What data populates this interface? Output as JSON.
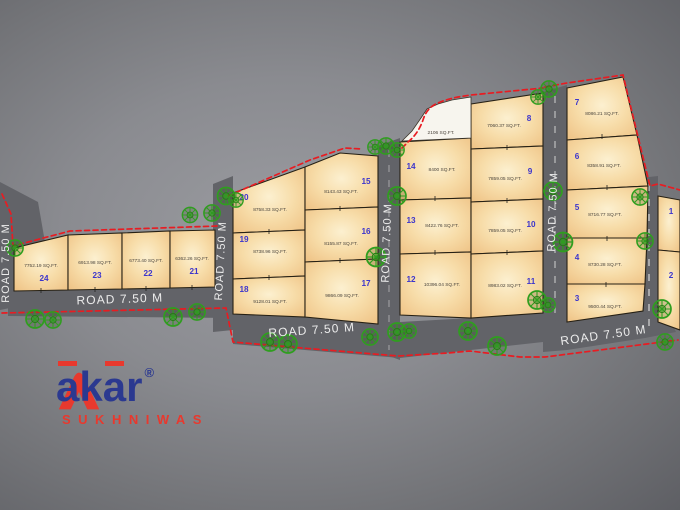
{
  "road_label": "ROAD 7.50 M",
  "open_plot": {
    "area": "2106 SQ.FT."
  },
  "plots": {
    "p1": {
      "num": "1",
      "area": ""
    },
    "p2": {
      "num": "2",
      "area": ""
    },
    "p3": {
      "num": "3",
      "area": "9500.44 SQ.FT."
    },
    "p4": {
      "num": "4",
      "area": "8730.28 SQ.FT."
    },
    "p5": {
      "num": "5",
      "area": "8716.77 SQ.FT."
    },
    "p6": {
      "num": "6",
      "area": "8358.91 SQ.FT."
    },
    "p7": {
      "num": "7",
      "area": "8086.21 SQ.FT."
    },
    "p8": {
      "num": "8",
      "area": "7060.37 SQ.FT."
    },
    "p9": {
      "num": "9",
      "area": "7859.05 SQ.FT."
    },
    "p10": {
      "num": "10",
      "area": "7859.05 SQ.FT."
    },
    "p11": {
      "num": "11",
      "area": "8983.02 SQ.FT."
    },
    "p12": {
      "num": "12",
      "area": "10396.04 SQ.FT."
    },
    "p13": {
      "num": "13",
      "area": "8422.76 SQ.FT."
    },
    "p14": {
      "num": "14",
      "area": "8400 SQ.FT."
    },
    "p15": {
      "num": "15",
      "area": "8143.43 SQ.FT."
    },
    "p16": {
      "num": "16",
      "area": "8155.87 SQ.FT."
    },
    "p17": {
      "num": "17",
      "area": "9866.09 SQ.FT."
    },
    "p18": {
      "num": "18",
      "area": "9128.01 SQ.FT."
    },
    "p19": {
      "num": "19",
      "area": "8738.96 SQ.FT."
    },
    "p20": {
      "num": "20",
      "area": "8758.33 SQ.FT."
    },
    "p21": {
      "num": "21",
      "area": "6362.26 SQ.FT."
    },
    "p22": {
      "num": "22",
      "area": "6773.40 SQ.FT."
    },
    "p23": {
      "num": "23",
      "area": "6913.98 SQ.FT."
    },
    "p24": {
      "num": "24",
      "area": "7752.19 SQ.FT."
    }
  },
  "logo": {
    "l1": "a",
    "l2": "k",
    "l3": "a",
    "l4": "r",
    "registered": "®",
    "subtitle": "SUKHNIWAS"
  },
  "colors": {
    "brand_red": "#e8392e",
    "brand_navy": "#2b3990",
    "plot_number_blue": "#3c35cc",
    "tree_green": "#2f9e1f",
    "boundary_red": "#e81c22",
    "parcel_fill": "#f6d79e",
    "road_gray": "#626368"
  }
}
